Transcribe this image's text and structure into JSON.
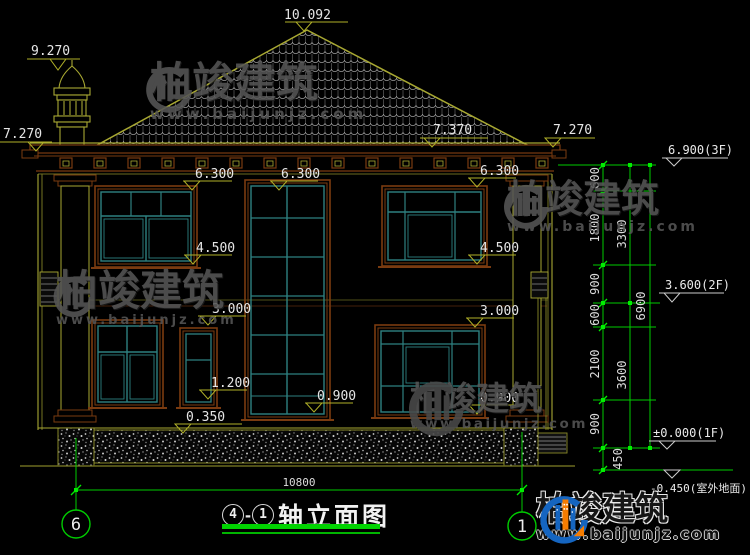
{
  "drawing": {
    "title": {
      "axis_from": "4",
      "separator": "-",
      "axis_to": "1",
      "name": "轴立面图"
    },
    "elevations": {
      "peak": "10.092",
      "chimney": "9.270",
      "eave_left": "7.270",
      "roof_slope": "7.370",
      "eave_right": "7.270",
      "f2_head_left": "6.300",
      "f2_head_center": "6.300",
      "f2_head_right": "6.300",
      "f2_sill_left": "4.500",
      "f2_sill_right": "4.500",
      "f1_head_left": "3.000",
      "f1_head_right": "3.000",
      "small_window_sill": "1.200",
      "center_window_sill": "0.900",
      "f1_sill_right": "0.900",
      "plinth_top": "0.350"
    },
    "floor_levels": {
      "third": "6.900(3F)",
      "second": "3.600(2F)",
      "first": "±0.000(1F)",
      "ground": "-0.450(室外地面)"
    },
    "vertical_dims": {
      "segments": [
        "600",
        "1800",
        "900",
        "600",
        "2100",
        "900",
        "450"
      ],
      "floor_heights": [
        "3300",
        "3600"
      ],
      "total": "6900"
    },
    "horizontal_dim": "10800",
    "axes": {
      "left": "6",
      "right": "1"
    }
  },
  "watermark": {
    "brand": "柏竣建筑",
    "url": "www.baijunjz.com"
  },
  "footer_logo": {
    "brand": "柏竣建筑",
    "url": "www.baijunjz.com"
  },
  "colors": {
    "wall_line": "#a8a832",
    "frame_brown": "#7a3b10",
    "frame_teal": "#2e8080",
    "dim_green": "#00cc00",
    "marker_yellow": "#b0b028",
    "text_white": "#e6e6e6",
    "underline_green": "#00d400",
    "logo_blue": "#1565c0",
    "logo_orange": "#f57c00"
  }
}
